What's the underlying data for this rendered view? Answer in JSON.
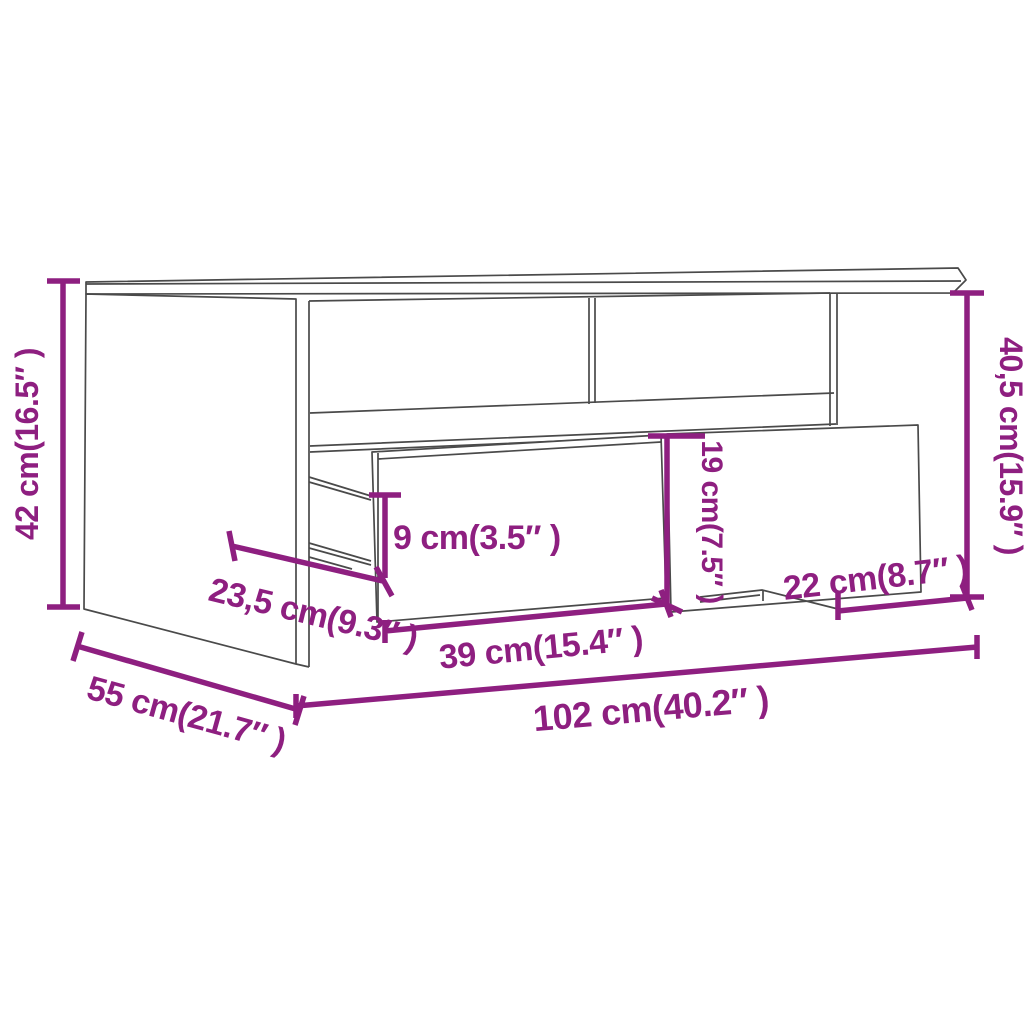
{
  "page": {
    "background": "#ffffff",
    "description": "Product dimension diagram of a coffee table with an open drawer"
  },
  "diagram": {
    "subject": "coffee-table-line-drawing",
    "style": {
      "dimension_color": "#8E1F80",
      "outline_color": "#4a4a4a",
      "background": "#ffffff"
    },
    "dimensions": [
      {
        "id": "overall-height-left",
        "label": "42 cm(16.5″ )",
        "orientation": "vertical-left"
      },
      {
        "id": "interior-height-right",
        "label": "40,5 cm(15.9″ )",
        "orientation": "vertical-right"
      },
      {
        "id": "drawer-front-height",
        "label": "19 cm(7.5″ )",
        "orientation": "vertical-middle"
      },
      {
        "id": "drawer-side-height",
        "label": "9 cm(3.5″ )",
        "orientation": "horizontal"
      },
      {
        "id": "drawer-depth",
        "label": "23,5 cm(9.3″ )",
        "orientation": "diagonal"
      },
      {
        "id": "drawer-width",
        "label": "39 cm(15.4″ )",
        "orientation": "horizontal"
      },
      {
        "id": "overall-width",
        "label": "102 cm(40.2″ )",
        "orientation": "horizontal-bottom"
      },
      {
        "id": "overall-depth",
        "label": "55 cm(21.7″ )",
        "orientation": "diagonal-bottom-left"
      },
      {
        "id": "right-section-width",
        "label": "22 cm(8.7″ )",
        "orientation": "horizontal-right"
      }
    ]
  }
}
